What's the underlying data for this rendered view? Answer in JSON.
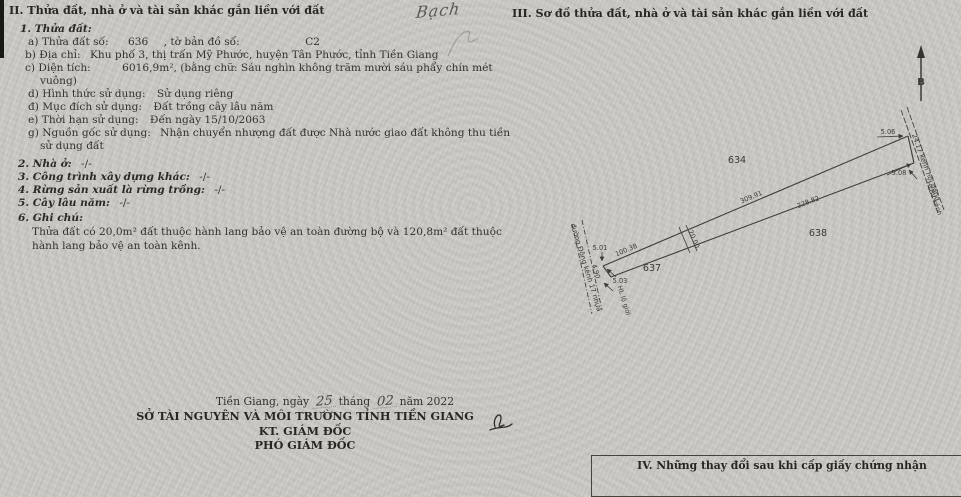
{
  "handwriting": {
    "top_note": "Bạch"
  },
  "section2": {
    "title": "II. Thửa đất, nhà ở và tài sản khác gắn liền với đất",
    "item1_title": "1. Thửa đất:",
    "a_label": "a) Thửa đất số:",
    "a_value": "636",
    "a_label2": ", tờ bản đồ số:",
    "a_value2": "C2",
    "b_label": "b) Địa chỉ:",
    "b_value": "Khu phố 3, thị trấn Mỹ Phước, huyện Tân Phước, tỉnh Tiền Giang",
    "c_label": "c) Diện tích:",
    "c_value": "6016,9m², (bằng chữ: Sáu nghìn không trăm mười sáu phẩy chín mét",
    "c_cont": "vuông)",
    "d_label": "d) Hình thức sử dụng:",
    "d_value": "Sử dụng riêng",
    "dd_label": "đ) Mục đích sử dụng:",
    "dd_value": "Đất trồng cây lâu năm",
    "e_label": "e) Thời hạn sử dụng:",
    "e_value": "Đến ngày 15/10/2063",
    "g_label": "g) Nguồn gốc sử dụng:",
    "g_value": "Nhận chuyển nhượng đất được Nhà nước giao đất không thu tiền",
    "g_cont": "sử dụng đất",
    "item2_label": "2. Nhà ở:",
    "item2_value": "-/-",
    "item3_label": "3. Công trình xây dựng khác:",
    "item3_value": "-/-",
    "item4_label": "4. Rừng sản xuất là rừng trồng:",
    "item4_value": "-/-",
    "item5_label": "5. Cây lâu năm:",
    "item5_value": "-/-",
    "item6_label": "6. Ghi chú:",
    "note_line1": "Thửa đất có 20,0m² đất thuộc hành lang bảo vệ an toàn đường bộ và 120,8m² đất thuộc",
    "note_line2": "hành lang bảo vệ an toàn kênh."
  },
  "signature_block": {
    "date_prefix": "Tiền Giang, ngày",
    "date_day": "25",
    "date_mid": "tháng",
    "date_month": "02",
    "date_suffix": "năm 2022",
    "org": "SỞ TÀI NGUYÊN VÀ MÔI TRƯỜNG TỈNH TIỀN GIANG",
    "kt_line": "KT. GIÁM ĐỐC",
    "title_line": "PHÓ GIÁM ĐỐC"
  },
  "section3": {
    "title": "III. Sơ đồ thửa đất, nhà ở và tài sản khác gắn liền với đất"
  },
  "diagram": {
    "north": "B",
    "parcel_634": "634",
    "parcel_637": "637",
    "parcel_638": "638",
    "dim_top": "309.91",
    "dim_bottom": "228.82",
    "dim_left": "100.38",
    "dim_width": "20.00",
    "edge_right_top": "5.06",
    "edge_right_bottom": "5.08",
    "edge_left_top": "5.01",
    "edge_left_mid": "4.90",
    "edge_left_bottom": "5.03",
    "road_label": "đường Đông kênh 17 nhựa",
    "road_easement": "HL lộ giới",
    "canal_label": "24.17 kênh nội đồng",
    "canal_easement": "HLBV kênh"
  },
  "section4": {
    "title": "IV. Những thay đổi sau khi cấp giấy chứng nhận"
  }
}
